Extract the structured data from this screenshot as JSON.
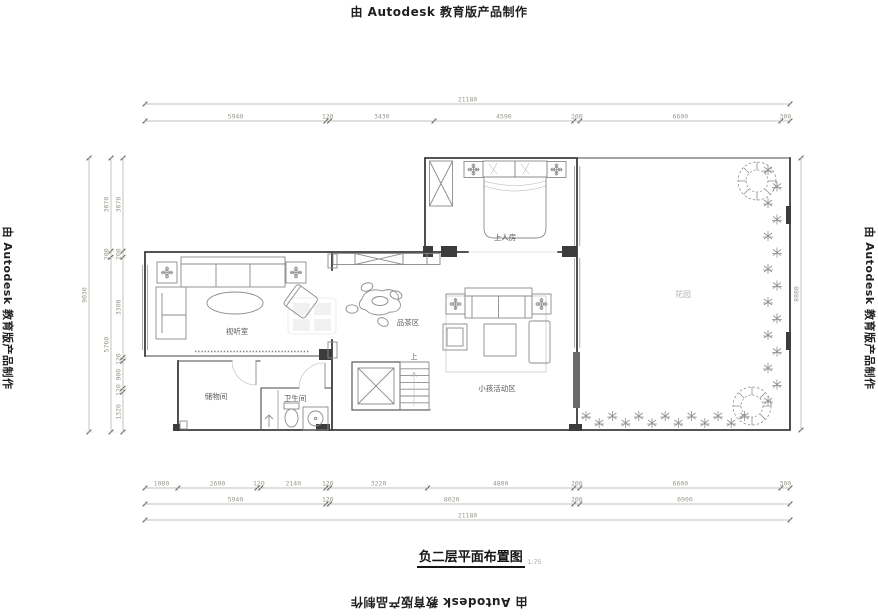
{
  "watermark": {
    "text": "由 Autodesk 教育版产品制作"
  },
  "title": {
    "text": "负二层平面布置图",
    "scale": "1:75"
  },
  "rooms": {
    "bedroom": "上人房",
    "av_room": "视听室",
    "tea_area": "品茶区",
    "kids_area": "小孩活动区",
    "bathroom": "卫生间",
    "storage": "储物间",
    "garden": "花园",
    "stair_up": "上"
  },
  "dimensions": {
    "top": {
      "overall": [
        21180
      ],
      "segments": [
        5940,
        120,
        3430,
        4590,
        200,
        6600,
        300
      ]
    },
    "left": {
      "overall": [
        9030
      ],
      "mid": [
        3070,
        200,
        5760
      ],
      "inner": [
        3070,
        200,
        3300,
        120,
        900,
        120,
        1320
      ]
    },
    "right": {
      "overall": [
        8880
      ]
    },
    "bottom": {
      "row1": [
        1080,
        2600,
        120,
        2140,
        120,
        3220,
        4800,
        200,
        6600,
        300
      ],
      "row2": [
        5940,
        120,
        8020,
        200,
        6900
      ],
      "row3": [
        21180
      ]
    }
  },
  "colors": {
    "wall": "#3c3c3c",
    "dimension": "#9a9a90",
    "furniture": "#8b8b8b",
    "label": "#5a5a5a"
  }
}
